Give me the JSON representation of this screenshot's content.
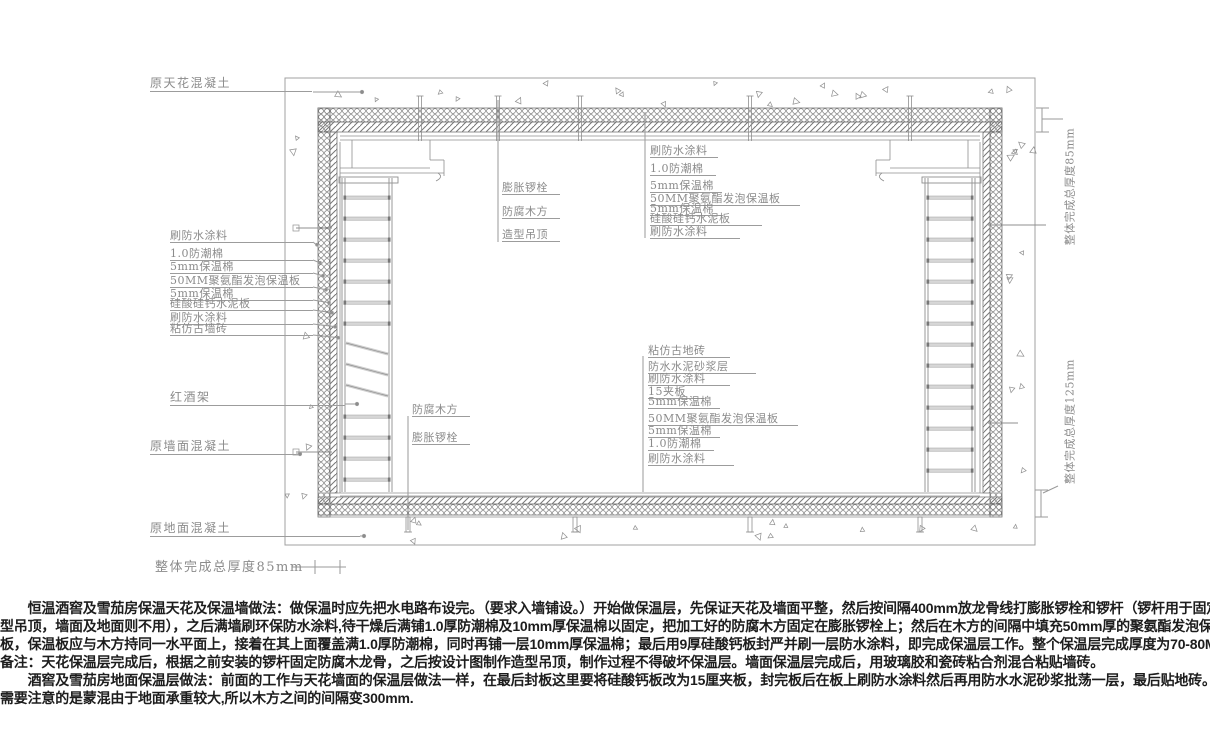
{
  "labels": {
    "ceiling_concrete": "原天花混凝土",
    "wall_layers": [
      "刷防水涂料",
      "1.0防潮棉",
      "5mm保温棉",
      "50MM聚氨酯发泡保温板",
      "5mm保温棉",
      "硅酸硅钙水泥板",
      "刷防水涂料",
      "粘仿古墙砖"
    ],
    "wine_rack": "红酒架",
    "wall_concrete": "原墙面混凝土",
    "floor_concrete": "原地面混凝土",
    "wall_total_thickness": "整体完成总厚度85mm",
    "anchor_bolt": "膨胀锣栓",
    "wood_batten": "防腐木方",
    "shaped_ceiling": "造型吊顶",
    "floor_wood_batten": "防腐木方",
    "floor_anchor_bolt": "膨胀锣栓",
    "ceiling_layers": [
      "刷防水涂料",
      "1.0防潮棉",
      "5mm保温棉",
      "50MM聚氨酯发泡保温板",
      "5mm保温棉",
      "硅酸硅钙水泥板",
      "刷防水涂料"
    ],
    "floor_layers": [
      "粘仿古地砖",
      "防水水泥砂浆层",
      "刷防水涂料",
      "15夹板",
      "5mm保温棉",
      "50MM聚氨酯发泡保温板",
      "5mm保温棉",
      "1.0防潮棉",
      "刷防水涂料"
    ],
    "ceiling_total_thickness": "整体完成总厚度85mm",
    "floor_total_thickness": "整体完成总厚度125mm"
  },
  "notes": {
    "lines": [
      "　　恒温酒窖及雪茄房保温天花及保温墙做法：做保温时应先把水电路布设完。（要求入墙铺设。）开始做保温层，先保证天花及墙面平整，然后按间隔400mm放龙骨线打膨胀锣栓和锣杆（锣杆用于固定造",
      "型吊顶，墙面及地面则不用），之后满墙刷环保防水涂料,待干燥后满铺1.0厚防潮棉及10mm厚保温棉以固定，把加工好的防腐木方固定在膨胀锣栓上；然后在木方的间隔中填充50mm厚的聚氨酯发泡保温",
      "板，保温板应与木方持同一水平面上，接着在其上面覆盖满1.0厚防潮棉，同时再铺一层10mm厚保温棉；最后用9厚硅酸钙板封严并刷一层防水涂料，即完成保温层工作。整个保温层完成厚度为70-80MM.",
      "备注：天花保温层完成后，根据之前安装的锣杆固定防腐木龙骨，之后按设计图制作造型吊顶，制作过程不得破坏保温层。墙面保温层完成后，用玻璃胶和瓷砖粘合剂混合粘贴墙砖。",
      "　　酒窖及雪茄房地面保温层做法：前面的工作与天花墙面的保温层做法一样，在最后封板这里要将硅酸钙板改为15厘夹板，封完板后在板上刷防水涂料然后再用防水水泥砂浆批荡一层，最后贴地砖。",
      "需要注意的是蒙混由于地面承重较大,所以木方之间的间隔变300mm."
    ]
  },
  "colors": {
    "drawing_line": "#8f8f8f",
    "hatch": "#777777",
    "label_text": "#8b8b8b",
    "note_text": "#1d1d1d"
  }
}
